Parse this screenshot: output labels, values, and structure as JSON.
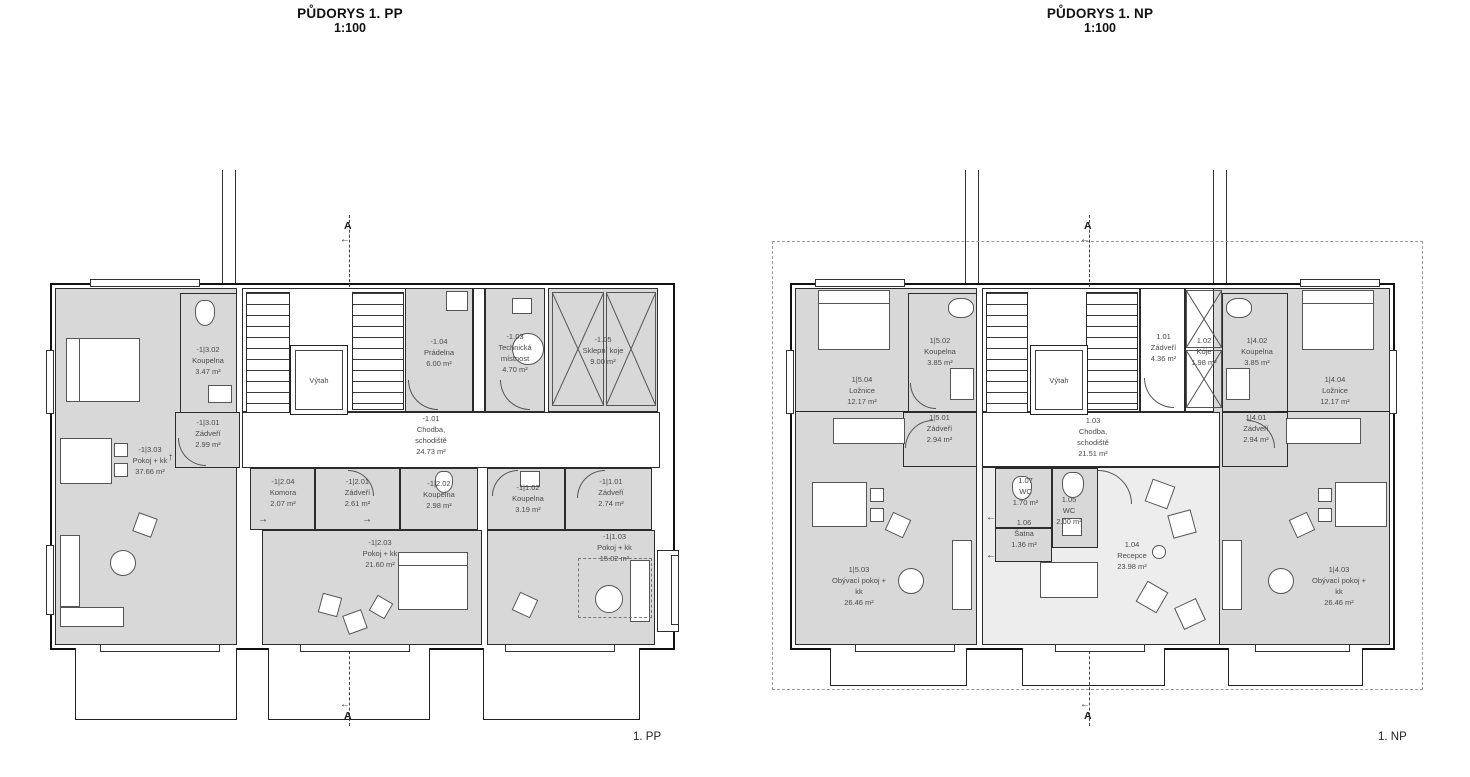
{
  "pp": {
    "heading": "PŮDORYS 1. PP",
    "scale": "1:100",
    "footer": "1. PP",
    "rooms": [
      {
        "id": "-1|3.02",
        "name": "Koupelna",
        "area": "3.47 m²"
      },
      {
        "id": "-1|3.01",
        "name": "Zádveří",
        "area": "2.99 m²"
      },
      {
        "id": "-1|3.03",
        "name": "Pokoj + kk",
        "area": "37.66 m²"
      },
      {
        "id": "-1.04",
        "name": "Prádelna",
        "area": "6.00 m²"
      },
      {
        "id": "-1.03",
        "name": "Technická místnost",
        "area": "4.70 m²"
      },
      {
        "id": "-1.05",
        "name": "Sklepní koje",
        "area": "9.00 m²"
      },
      {
        "id": "-1.01",
        "name": "Chodba, schodiště",
        "area": "24.73 m²"
      },
      {
        "id": "-1|2.04",
        "name": "Komora",
        "area": "2.07 m²"
      },
      {
        "id": "-1|2.01",
        "name": "Zádveří",
        "area": "2.61 m²"
      },
      {
        "id": "-1|2.02",
        "name": "Koupelna",
        "area": "2.98 m²"
      },
      {
        "id": "-1|1.02",
        "name": "Koupelna",
        "area": "3.19 m²"
      },
      {
        "id": "-1|1.01",
        "name": "Zádveří",
        "area": "2.74 m²"
      },
      {
        "id": "-1|2.03",
        "name": "Pokoj + kk",
        "area": "21.60 m²"
      },
      {
        "id": "-1|1.03",
        "name": "Pokoj + kk",
        "area": "15.02 m²"
      }
    ]
  },
  "np": {
    "heading": "PŮDORYS 1. NP",
    "scale": "1:100",
    "footer": "1. NP",
    "rooms": [
      {
        "id": "1|5.02",
        "name": "Koupelna",
        "area": "3.85 m²"
      },
      {
        "id": "1|5.04",
        "name": "Ložnice",
        "area": "12.17 m²"
      },
      {
        "id": "1|5.01",
        "name": "Zádveří",
        "area": "2.94 m²"
      },
      {
        "id": "1.01",
        "name": "Zádveří",
        "area": "4.36 m²"
      },
      {
        "id": "1.02",
        "name": "Kóje",
        "area": "1.98 m²"
      },
      {
        "id": "1.03",
        "name": "Chodba, schodiště",
        "area": "21.51 m²"
      },
      {
        "id": "1|4.02",
        "name": "Koupelna",
        "area": "3.85 m²"
      },
      {
        "id": "1|4.04",
        "name": "Ložnice",
        "area": "12.17 m²"
      },
      {
        "id": "1|4.01",
        "name": "Zádveří",
        "area": "2.94 m²"
      },
      {
        "id": "1.07",
        "name": "WC",
        "area": "1.70 m²"
      },
      {
        "id": "1.05",
        "name": "WC",
        "area": "2.00 m²"
      },
      {
        "id": "1.06",
        "name": "Šatna",
        "area": "1.36 m²"
      },
      {
        "id": "1|5.03",
        "name": "Obývací pokoj + kk",
        "area": "26.46 m²"
      },
      {
        "id": "1.04",
        "name": "Recepce",
        "area": "23.98 m²"
      },
      {
        "id": "1|4.03",
        "name": "Obývací pokoj + kk",
        "area": "26.46 m²"
      }
    ]
  },
  "elevator_label": "Výtah",
  "section": {
    "label": "A"
  },
  "glyphs": {
    "left_arrow": "←",
    "right_arrow": "→",
    "up_arrow": "↑"
  },
  "colors": {
    "room_fill": "#d8d8d8",
    "reception_fill": "#ededed",
    "wall": "#1a1a1a",
    "label_text": "#4a4a4a",
    "background": "#ffffff"
  }
}
